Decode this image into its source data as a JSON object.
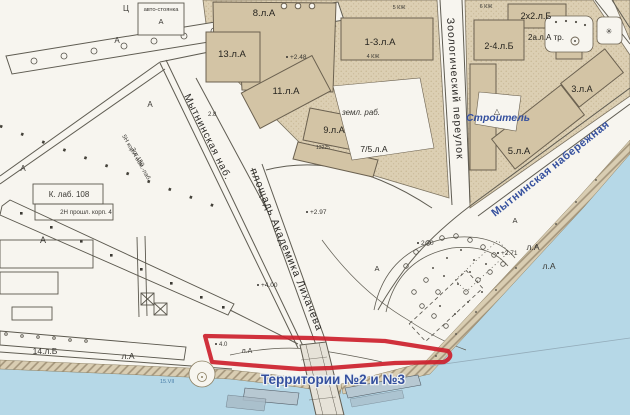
{
  "map": {
    "area_label": "Территории №2 и №3",
    "streets": [
      {
        "name": "Мытнинская наб."
      },
      {
        "name": "площадь Академика Лихачева"
      },
      {
        "name": "Зоологический переулок"
      },
      {
        "name": "Мытнинская набережная"
      }
    ],
    "building_labels": [
      "8.л.А",
      "13.л.А",
      "11.л.А",
      "1-3.л.А",
      "9.л.А",
      "7/5.л.А",
      "2х2.л.Б",
      "2-4.л.Б",
      "2а.л.А тр.",
      "3.л.А",
      "5.л.А",
      "14.л.Б",
      "К. лаб. 108",
      "2Н  прошл. корп. 4",
      "5Н кор.А обм.-лаб.",
      "Зот.159"
    ],
    "annotations": {
      "parking": "авто-стоянка",
      "stroitel": "Строитель",
      "zeml_rab": "земл. раб.",
      "liter_a": "л.А",
      "letter_a": "А",
      "letter_ts": "Ц",
      "triangle": "△",
      "asterisk": "✳"
    },
    "elevation_marks": [
      "+2.48",
      "+2.97",
      "+4.00",
      "2.70",
      "+2.71",
      "2.8",
      "4.0",
      "13225",
      "15.VII"
    ],
    "small_labels": [
      "5 КЖ",
      "4 КЖ",
      "6 КЖ"
    ],
    "colors": {
      "water": "#b6d8e7",
      "block_fill": "#dccfb3",
      "building_fill": "#d3c4a5",
      "red_outline": "#cc202c",
      "blue_label": "#35509e"
    }
  }
}
